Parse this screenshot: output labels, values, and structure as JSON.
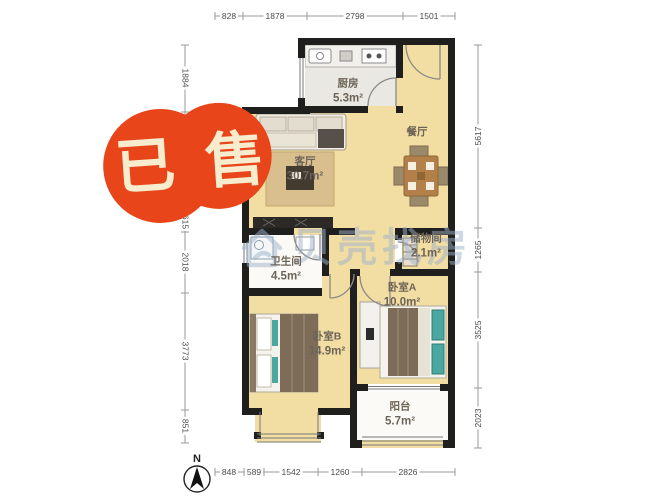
{
  "stamp": {
    "text": "已售"
  },
  "watermark": {
    "text": "贝壳找房"
  },
  "compass": {
    "label": "N"
  },
  "rooms": {
    "kitchen": {
      "label": "厨房",
      "area": "5.3m²"
    },
    "dining": {
      "label": "餐厅"
    },
    "living": {
      "label": "客厅",
      "area": "30.7m²"
    },
    "bathroom": {
      "label": "卫生间",
      "area": "4.5m²"
    },
    "storage": {
      "label": "储物间",
      "area": "2.1m²"
    },
    "bedroomA": {
      "label": "卧室A",
      "area": "10.0m²"
    },
    "bedroomB": {
      "label": "卧室B",
      "area": "14.9m²"
    },
    "balcony": {
      "label": "阳台",
      "area": "5.7m²"
    }
  },
  "dimensions": {
    "top": [
      "828",
      "1878",
      "2798",
      "1501"
    ],
    "left": [
      "1884",
      "615",
      "2018",
      "3773",
      "851"
    ],
    "right": [
      "5617",
      "1265",
      "3525",
      "2023"
    ],
    "bottom": [
      "848",
      "589",
      "1542",
      "1260",
      "2826"
    ]
  },
  "colors": {
    "floor_yellow": "#f2dda2",
    "floor_gray": "#e9e8e3",
    "floor_white": "#fbfaf6",
    "wall": "#1f1f1e",
    "thin_line": "#777777",
    "door_line": "#8a8a8a",
    "dim_line": "#9a9a9a",
    "dim_text": "#4a4a4a",
    "label": "#6d6458",
    "stamp": "#e8461a",
    "stamp_text": "#f7eccd",
    "watermark": "#9fb3cc",
    "wood": "#b28048",
    "rug": "#d9bf8d",
    "blanket": "#7d6c58",
    "teal": "#4aa8a0",
    "sofa": "#f1ede2",
    "counter": "#f1f0ec",
    "dark": "#2b2a27"
  }
}
